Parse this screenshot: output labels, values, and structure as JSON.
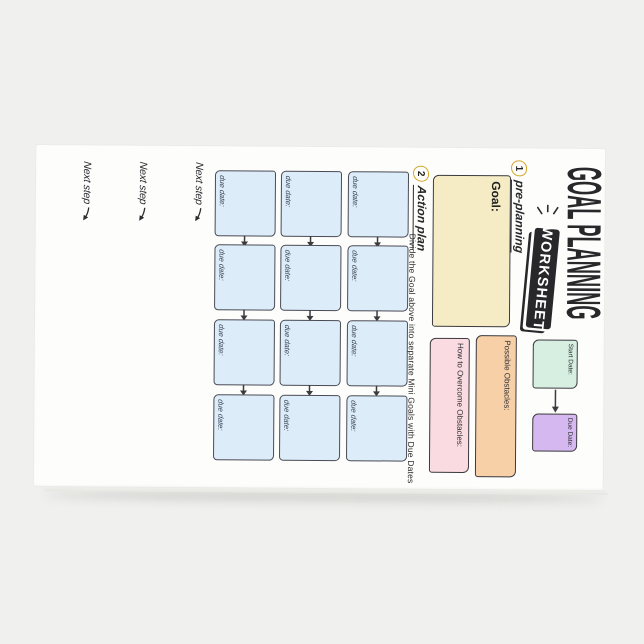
{
  "page": {
    "background": "#f0f0ee",
    "pad_color": "#fdfdfc"
  },
  "pad": {
    "title": "GOAL PLANNING",
    "banner": "WORKSHEET",
    "steps": {
      "step1_num": "1",
      "step1_label": "pre-planning",
      "step2_num": "2",
      "step2_label": "Action plan",
      "step2_instruction": "Divide the Goal above into separate Mini Goals with Due Dates"
    },
    "goal": {
      "label": "Goal:"
    },
    "mini_goals": {
      "due_label": "due date:",
      "rows": 3,
      "cols": 4
    },
    "obstacles": {
      "possible_label": "Possible Obstacles:",
      "overcome_label": "How to Overcome Obstacles:"
    },
    "dates": {
      "start_label": "Start Date:",
      "due_label": "Due Date:"
    },
    "next_step": {
      "label": "Next step",
      "count": 3
    },
    "colors": {
      "ink": "#28282b",
      "banner_bg": "#28282b",
      "step_circle": "#d4a62c",
      "goal_fill": "#f5ecc6",
      "mini_goal_fill": "#dcedf9",
      "possible_obstacles_fill": "#f8d0a8",
      "overcome_obstacles_fill": "#f9dbe1",
      "start_date_fill": "#d6efe1",
      "due_date_fill": "#d5b8f0"
    }
  }
}
